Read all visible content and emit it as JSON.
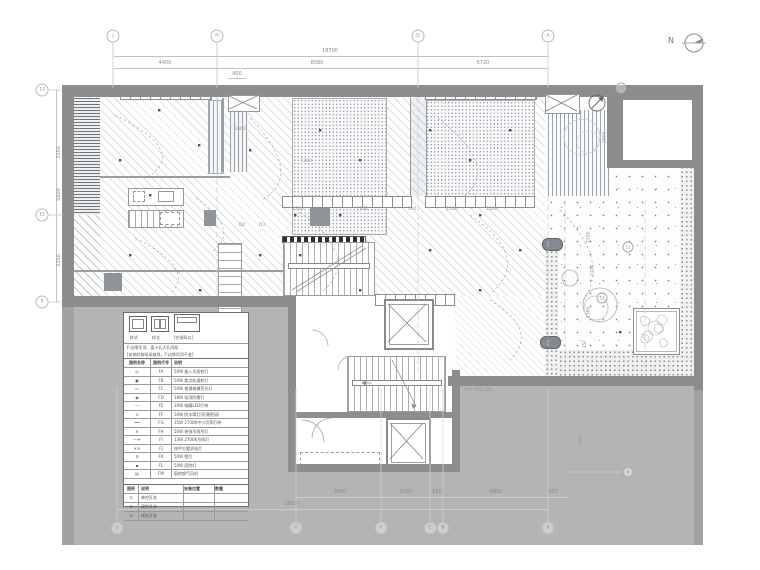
{
  "north_label": "N",
  "grid": {
    "top": [
      {
        "label": "J",
        "x": 113
      },
      {
        "label": "H",
        "x": 217
      },
      {
        "label": "D",
        "x": 418
      },
      {
        "label": "A",
        "x": 548
      }
    ],
    "bottom": [
      {
        "label": "J",
        "x": 117
      },
      {
        "label": "G",
        "x": 296
      },
      {
        "label": "F",
        "x": 381
      },
      {
        "label": "C",
        "x": 430
      },
      {
        "label": "B",
        "x": 443
      },
      {
        "label": "A",
        "x": 548
      }
    ],
    "left": [
      {
        "label": "13",
        "y": 90
      },
      {
        "label": "12",
        "y": 215
      },
      {
        "label": "9",
        "y": 302
      }
    ],
    "plan_markers": [
      {
        "label": "11",
        "x": 621,
        "y": 88
      },
      {
        "label": "11",
        "x": 628,
        "y": 247
      },
      {
        "label": "13",
        "x": 602,
        "y": 298
      },
      {
        "label": "4",
        "x": 628,
        "y": 472
      }
    ]
  },
  "dimensions": {
    "top_total": {
      "text": "18700",
      "x": 330
    },
    "top_segments": [
      {
        "text": "4400",
        "x": 165
      },
      {
        "text": "8580",
        "x": 317
      },
      {
        "text": "5720",
        "x": 483
      }
    ],
    "top_sub": {
      "text": "400",
      "x": 237
    },
    "left_dims": [
      {
        "text": "3350",
        "x": 52,
        "y": 150,
        "rot": -90
      },
      {
        "text": "5600",
        "x": 52,
        "y": 192,
        "rot": -90
      },
      {
        "text": "3250",
        "x": 52,
        "y": 258,
        "rot": -90
      }
    ],
    "bottom_segments": [
      {
        "text": "3800",
        "x": 340
      },
      {
        "text": "2160",
        "x": 406
      },
      {
        "text": "560",
        "x": 437
      },
      {
        "text": "4850",
        "x": 496
      },
      {
        "text": "650",
        "x": 553
      }
    ],
    "bottom_total": {
      "text": "18700",
      "x": 292
    },
    "plan_labels": [
      {
        "text": "1860",
        "x": 240,
        "y": 128
      },
      {
        "text": "1260",
        "x": 306,
        "y": 160
      },
      {
        "text": "1740",
        "x": 298,
        "y": 208
      },
      {
        "text": "1760",
        "x": 362,
        "y": 208
      },
      {
        "text": "310",
        "x": 412,
        "y": 208
      },
      {
        "text": "1200",
        "x": 452,
        "y": 208
      },
      {
        "text": "1200",
        "x": 492,
        "y": 208
      },
      {
        "text": "D2",
        "x": 242,
        "y": 224
      },
      {
        "text": "D3",
        "x": 262,
        "y": 224
      },
      {
        "text": "3600",
        "x": 600,
        "y": 135,
        "rot": -90
      },
      {
        "text": "2280",
        "x": 584,
        "y": 235,
        "rot": -90
      },
      {
        "text": "2200",
        "x": 588,
        "y": 268,
        "rot": -90
      },
      {
        "text": "1580",
        "x": 584,
        "y": 310,
        "rot": -90
      },
      {
        "text": "350",
        "x": 582,
        "y": 342,
        "rot": -90
      },
      {
        "text": "400 400 200",
        "x": 478,
        "y": 389
      },
      {
        "text": "2420",
        "x": 576,
        "y": 438,
        "rot": -90
      }
    ]
  },
  "legend": {
    "box_captions": [
      "样式",
      "样式",
      "[空调风口]"
    ],
    "notes": [
      "F:边缘吊顶、离小孔大孔间距",
      "[安装时按现场放线，F:边缘吊顶不变]"
    ],
    "header": {
      "c1": "图例名称",
      "c2": "图例代号",
      "c3": "说明"
    },
    "rows": [
      {
        "symbol": "◎",
        "code": "FA",
        "desc": "50W 嵌入式投射灯"
      },
      {
        "symbol": "▣",
        "code": "FB",
        "desc": "50W 焦点轨道射灯"
      },
      {
        "symbol": "▭",
        "code": "FC",
        "desc": "50W 普通格栅荧光灯"
      },
      {
        "symbol": "◉",
        "code": "FD",
        "desc": "18W 吸顶防雾灯"
      },
      {
        "symbol": "┈┈",
        "code": "FE",
        "desc": "20W 暗藏LED灯带"
      },
      {
        "symbol": "⊙",
        "code": "FF",
        "desc": "50W 防水筒灯(防潮密闭)"
      },
      {
        "symbol": "━━",
        "code": "FG",
        "desc": "35W 2700K中小功率灯带"
      },
      {
        "symbol": "✕",
        "code": "FH",
        "desc": "50W 装饰吊线吊灯"
      },
      {
        "symbol": "—✛",
        "code": "FI",
        "desc": "13W 2700K吊线灯"
      },
      {
        "symbol": "✕✕",
        "code": "FJ",
        "desc": "按甲方要求选灯"
      },
      {
        "symbol": "♀",
        "code": "FK",
        "desc": "50W 壁灯"
      },
      {
        "symbol": "▪",
        "code": "FL",
        "desc": "50W 庭院灯"
      },
      {
        "symbol": "▤",
        "code": "FM",
        "desc": "厨房换气风机"
      }
    ]
  },
  "switch_table": {
    "header": {
      "s1": "图例",
      "s2": "说明",
      "s3": "安装位置",
      "s4": "数量"
    },
    "rows": [
      {
        "symbol": "①",
        "desc": "单控开关"
      },
      {
        "symbol": "②",
        "desc": "双控开关"
      },
      {
        "symbol": "③",
        "desc": "调光开关"
      }
    ]
  }
}
